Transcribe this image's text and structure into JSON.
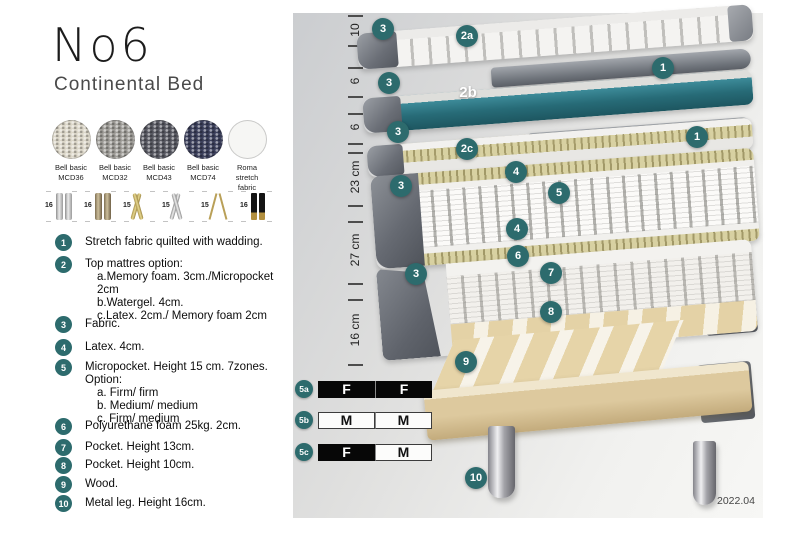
{
  "product": {
    "title": "No6",
    "subtitle": "Continental Bed"
  },
  "colors": {
    "accent_teal": "#2d6b6d",
    "layer_teal": "#2f7b89",
    "khaki": "#cfc692",
    "wood": "#ddc99e"
  },
  "swatches": [
    {
      "name": "Bell basic MCD36",
      "l1": "Bell basic",
      "l2": "MCD36",
      "color": "#dcd7c9"
    },
    {
      "name": "Bell basic MCD32",
      "l1": "Bell basic",
      "l2": "MCD32",
      "color": "#9e9c97"
    },
    {
      "name": "Bell basic MCD43",
      "l1": "Bell basic",
      "l2": "MCD43",
      "color": "#585962"
    },
    {
      "name": "Bell basic MCD74",
      "l1": "Bell basic",
      "l2": "MCD74",
      "color": "#3c405c"
    },
    {
      "name": "Roma stretch fabric",
      "l1": "Roma",
      "l2": "stretch fabric",
      "color": "#f6f6f4"
    }
  ],
  "legs": [
    {
      "height": "16",
      "kind": "cylinder-silver"
    },
    {
      "height": "16",
      "kind": "cylinder-bronze"
    },
    {
      "height": "15",
      "kind": "crossed-gold"
    },
    {
      "height": "15",
      "kind": "crossed-silver"
    },
    {
      "height": "15",
      "kind": "hairpin-gold"
    },
    {
      "height": "16",
      "kind": "cylinder-black-gold"
    }
  ],
  "features": [
    {
      "num": "1",
      "text": "Stretch fabric quilted with wadding."
    },
    {
      "num": "2",
      "text": "Top mattres option:",
      "subs": [
        "a.Memory foam. 3cm./Micropocket 2cm",
        "b.Watergel. 4cm.",
        "c.Latex. 2cm./ Memory foam 2cm"
      ]
    },
    {
      "num": "3",
      "text": "Fabric."
    },
    {
      "num": "4",
      "text": "Latex. 4cm."
    },
    {
      "num": "5",
      "text": "Micropocket. Height 15 cm. 7zones. Option:",
      "subs": [
        "a. Firm/ firm",
        "b. Medium/ medium",
        "c. Firm/ medium"
      ]
    },
    {
      "num": "6",
      "text": "Polyurethane foam 25kg. 2cm."
    },
    {
      "num": "7",
      "text": "Pocket. Height 13cm."
    },
    {
      "num": "8",
      "text": "Pocket. Height 10cm."
    },
    {
      "num": "9",
      "text": "Wood."
    },
    {
      "num": "10",
      "text": "Metal leg. Height 16cm."
    }
  ],
  "diagram": {
    "dimensions": {
      "d10": "10",
      "d6a": "6",
      "d6b": "6",
      "d23": "23 cm",
      "d27": "27 cm",
      "d16": "16 cm"
    },
    "callouts": {
      "c3a": "3",
      "c2a": "2a",
      "c1a": "1",
      "c3b": "3",
      "t2b": "2b",
      "c3c": "3",
      "c2c": "2c",
      "c1b": "1",
      "c3d": "3",
      "c4a": "4",
      "c5": "5",
      "c4b": "4",
      "c6": "6",
      "c7": "7",
      "c8": "8",
      "c3e": "3",
      "c9": "9",
      "c10": "10"
    },
    "firmness": {
      "rows": [
        {
          "id": "5a",
          "cells": [
            {
              "text": "F",
              "variant": "dark"
            },
            {
              "text": "F",
              "variant": "dark"
            }
          ]
        },
        {
          "id": "5b",
          "cells": [
            {
              "text": "M",
              "variant": "light"
            },
            {
              "text": "M",
              "variant": "light"
            }
          ]
        },
        {
          "id": "5c",
          "cells": [
            {
              "text": "F",
              "variant": "dark"
            },
            {
              "text": "M",
              "variant": "light"
            }
          ]
        }
      ]
    },
    "version": "2022.04"
  }
}
